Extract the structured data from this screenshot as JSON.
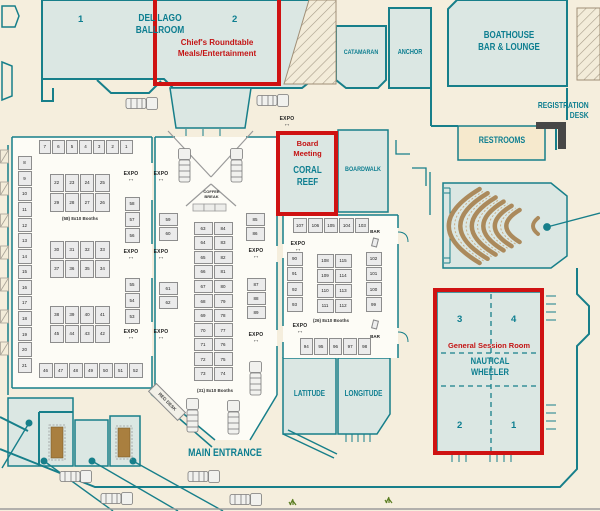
{
  "rooms": {
    "del_lago": {
      "label": "DEL LAGO BALLROOM",
      "n1": "1",
      "n2": "2"
    },
    "chiefs": {
      "line1": "Chief's Roundtable",
      "line2": "Meals/Entertainment"
    },
    "catamaran": "CATAMARAN",
    "anchor": "ANCHOR",
    "boathouse": {
      "line1": "BOATHOUSE",
      "line2": "BAR & LOUNGE"
    },
    "registration": {
      "line1": "REGISTRATION",
      "line2": "DESK"
    },
    "restrooms": "RESTROOMS",
    "board_meeting": {
      "line1": "Board",
      "line2": "Meeting"
    },
    "coral_reef": {
      "line1": "CORAL",
      "line2": "REEF"
    },
    "boardwalk": "BOARDWALK",
    "latitude": "LATITUDE",
    "longitude": "LONGITUDE",
    "general_session": "General Session Room",
    "nautical": {
      "line1": "NAUTICAL",
      "line2": "WHEELER",
      "q1": "1",
      "q2": "2",
      "q3": "3",
      "q4": "4"
    },
    "main_entrance": "MAIN ENTRANCE",
    "coffee_break": {
      "line1": "COFFEE",
      "line2": "BREAK"
    },
    "reg_desk": "REG DESK",
    "expo": "EXPO",
    "bar": "BAR"
  },
  "halls": {
    "left": {
      "count_label": "(58) 8x10 Booths",
      "top_row": [
        "7",
        "6",
        "5",
        "4",
        "3",
        "2",
        "1"
      ],
      "left_col": [
        "8",
        "9",
        "10",
        "11",
        "12",
        "13",
        "14",
        "15",
        "16",
        "17",
        "18",
        "19",
        "20",
        "21"
      ],
      "blocks": [
        [
          [
            "22",
            "23",
            "24",
            "25"
          ],
          [
            "29",
            "28",
            "27",
            "26"
          ]
        ],
        [
          [
            "30",
            "31",
            "32",
            "33"
          ],
          [
            "37",
            "36",
            "35",
            "34"
          ]
        ],
        [
          [
            "38",
            "39",
            "40",
            "41"
          ],
          [
            "45",
            "44",
            "43",
            "42"
          ]
        ]
      ],
      "bottom_row": [
        "46",
        "47",
        "48",
        "49",
        "50",
        "51",
        "52"
      ],
      "right_col_top": [
        "58",
        "57",
        "56"
      ],
      "right_col_bottom": [
        "55",
        "54",
        "53"
      ]
    },
    "center": {
      "count_label": "(31) 8x10 Booths",
      "left_top": [
        "59",
        "60"
      ],
      "left_bottom": [
        "61",
        "62"
      ],
      "rows": [
        [
          "63",
          "84"
        ],
        [
          "64",
          "83"
        ],
        [
          "65",
          "82"
        ],
        [
          "66",
          "81"
        ],
        [
          "67",
          "80"
        ],
        [
          "68",
          "79"
        ],
        [
          "69",
          "78"
        ],
        [
          "70",
          "77"
        ],
        [
          "71",
          "76"
        ],
        [
          "72",
          "75"
        ],
        [
          "73",
          "74"
        ]
      ],
      "right_top": [
        "85",
        "86"
      ],
      "right_bottom": [
        "87",
        "88",
        "89"
      ]
    },
    "right": {
      "count_label": "(26) 8x10 Booths",
      "top_row": [
        "107",
        "106",
        "105",
        "104",
        "103"
      ],
      "left_col": [
        "90",
        "91",
        "92",
        "93"
      ],
      "rows": [
        [
          "108",
          "115"
        ],
        [
          "109",
          "114"
        ],
        [
          "110",
          "113"
        ],
        [
          "111",
          "112"
        ]
      ],
      "right_col": [
        "102",
        "101",
        "100",
        "99"
      ],
      "bottom_row": [
        "94",
        "95",
        "96",
        "97",
        "98"
      ]
    }
  },
  "colors": {
    "wall_teal": "#177f8a",
    "label_teal": "#0d7e90",
    "highlight_red": "#cf1212",
    "room_fill": "#dbe7e3",
    "restroom_fill": "#f6e9cd",
    "seat_brown": "#ab8a5c",
    "background": "#f5eedd"
  }
}
